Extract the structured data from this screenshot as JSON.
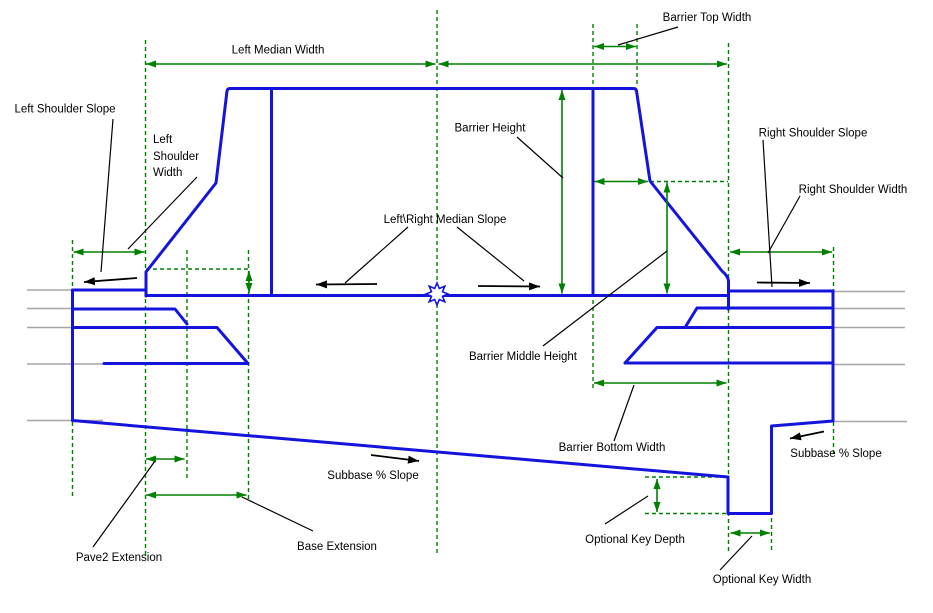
{
  "diagram_type": "roadway-median-barrier-cross-section",
  "colors": {
    "structure_blue": "#1414dd",
    "dimension_green": "#008000",
    "annotation_black": "#000000",
    "ground_gray": "#a6a6a6",
    "background": "#ffffff"
  },
  "labels": {
    "left_shoulder_slope": "Left Shoulder Slope",
    "left_shoulder_width_lines": [
      "Left",
      "Shoulder",
      "Width"
    ],
    "left_median_width": "Left Median Width",
    "barrier_top_width": "Barrier Top Width",
    "barrier_height": "Barrier Height",
    "left_right_median_slope": "Left\\Right Median Slope",
    "right_shoulder_slope": "Right Shoulder Slope",
    "right_shoulder_width": "Right Shoulder Width",
    "barrier_middle_height": "Barrier Middle Height",
    "barrier_bottom_width": "Barrier Bottom Width",
    "subbase_slope_center": "Subbase % Slope",
    "subbase_slope_right": "Subbase % Slope",
    "pave2_extension": "Pave2 Extension",
    "base_extension": "Base Extension",
    "optional_key_depth": "Optional Key Depth",
    "optional_key_width": "Optional Key Width"
  }
}
